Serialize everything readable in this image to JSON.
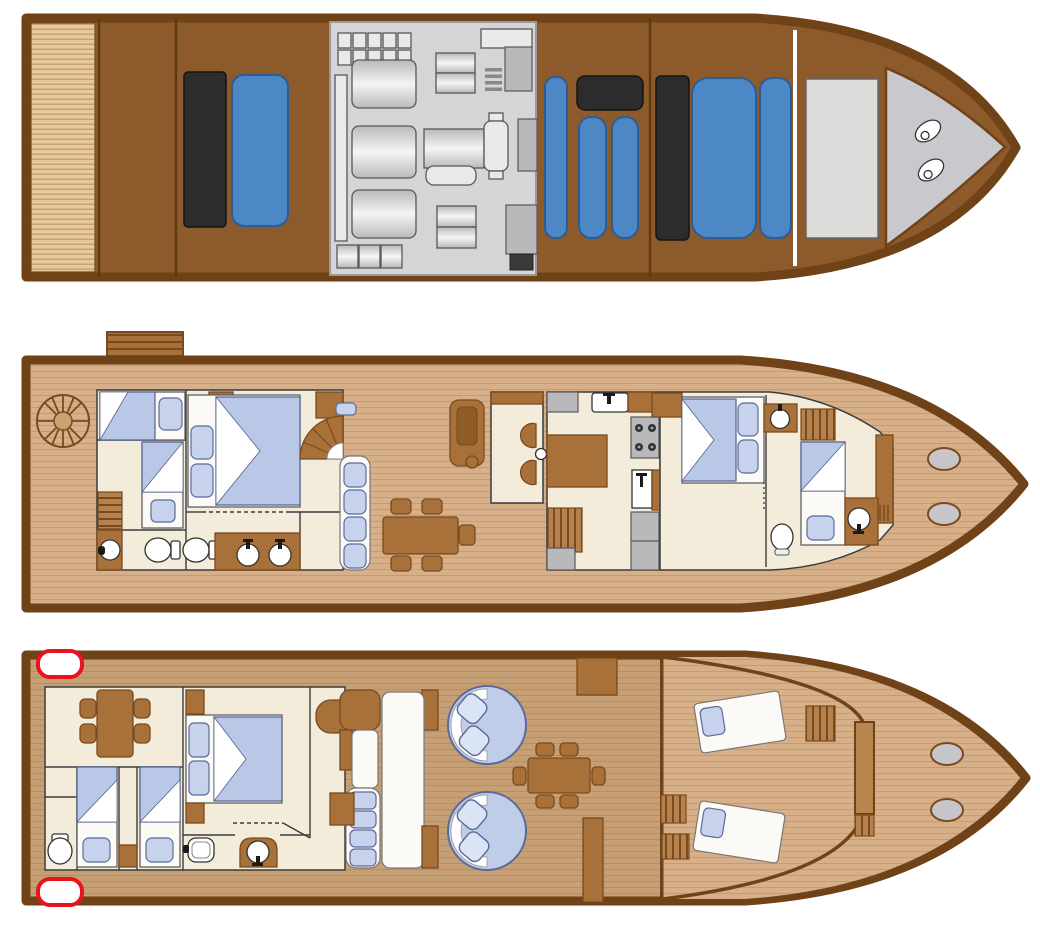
{
  "title": "yacht-three-deck-floor-plan",
  "page": {
    "background": "#ffffff"
  },
  "colors": {
    "page-bg": "#ffffff",
    "hull-border": "#6f4217",
    "deck-brown": "#8d5b2b",
    "divider": "#5e3a12",
    "transom-bg": "#e5c99b",
    "transom-line": "#c7a26e",
    "engine-bg": "#d5d5d7",
    "machine-fill": "#e9e9ea",
    "machine-mid": "#b9b9bc",
    "machine-dark": "#3a3a3c",
    "machine-border": "#58585a",
    "tank-blue": "#4c87c6",
    "tank-blue-border": "#2d5c96",
    "tank-black": "#2c2c2c",
    "bow-gray": "#c9c9cd",
    "plank-bg": "#d7af88",
    "plank-line": "#c49c74",
    "salon-bg": "#c79f74",
    "salon-line": "#b78d61",
    "room-floor": "#f3ecda",
    "wall": "#3c3c3c",
    "wood-mid": "#a9713a",
    "wood-dark": "#7a4a1e",
    "wood-step": "#b5824d",
    "bed-white": "#fbfaf6",
    "bed-blue": "#b9c8e6",
    "bed-border": "#51618c",
    "cushion-blue": "#c7d3ec",
    "cushion-border": "#5a6a9a",
    "fixture-border": "#333333",
    "hatch-gray": "#c6c6ca",
    "fender-red": "#e8131f",
    "round-seat": "#bfcde8",
    "console-brown": "#b8854f"
  },
  "decks": [
    {
      "id": "tank-engine-deck",
      "position": "top",
      "items": [
        "swim-platform",
        "black-fuel-tank",
        "blue-water-tank",
        "engine-room",
        "battery-bank",
        "main-engines",
        "generator",
        "midship-blue-tanks",
        "black-holding-tank",
        "forward-locker",
        "bow-anchor-hatches"
      ]
    },
    {
      "id": "lower-accommodation-deck",
      "position": "middle",
      "items": [
        "gangway",
        "capstan-wheel",
        "aft-twin-cabin",
        "single-berth",
        "aft-master-cabin",
        "bathroom-toilets",
        "bathroom-sinks",
        "companionway-stairs",
        "spiral-stairs",
        "wall-settee",
        "lounge-chair",
        "dining-table",
        "helm-station",
        "galley-sink",
        "stove",
        "fridge",
        "fore-master-cabin",
        "fore-single-cabin",
        "fore-toilet",
        "deck-hatches"
      ]
    },
    {
      "id": "main-deck",
      "position": "bottom",
      "items": [
        "stern-fenders",
        "card-table",
        "twin-single-cabins",
        "wc",
        "salon-master-cabin",
        "vanity-sink",
        "toilet-alcove",
        "helm-seat",
        "u-settee",
        "round-lounges",
        "cockpit-dining-table",
        "deck-lockers",
        "windshield",
        "steering-console",
        "companionway-steps",
        "sun-loungers",
        "foredeck-hatches"
      ]
    }
  ]
}
